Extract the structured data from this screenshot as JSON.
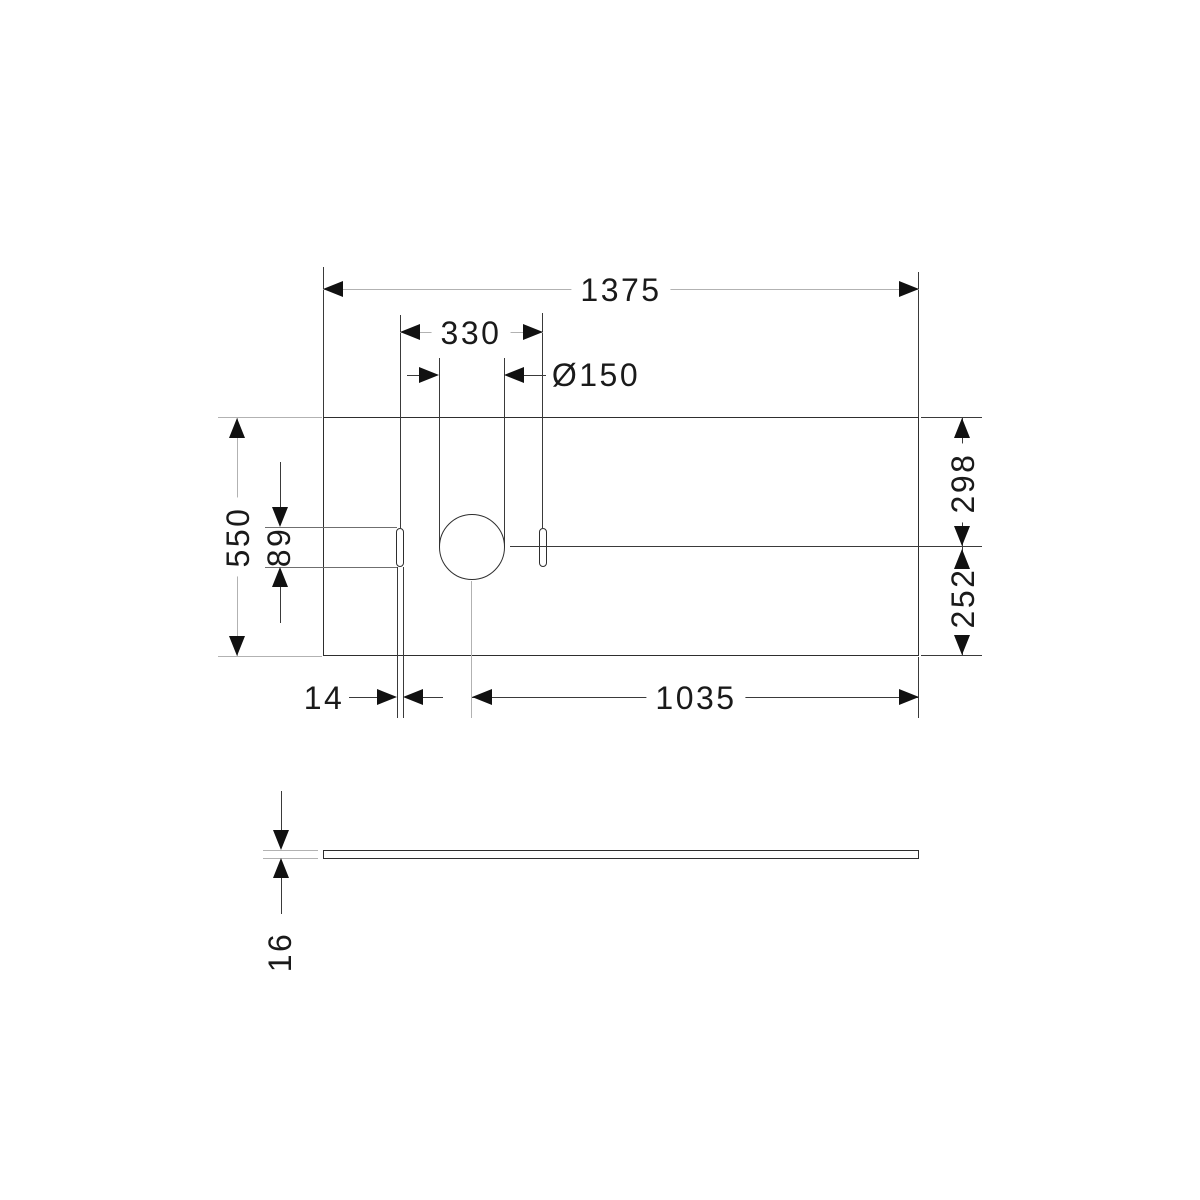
{
  "drawing": {
    "type": "technical-dimension-drawing",
    "views": {
      "top_view": "plate with one round hole and two slotted holes",
      "side_view": "thin plate profile"
    },
    "dimensions": {
      "overall_width": "1375",
      "slot_to_slot": "330",
      "hole_diameter": "Ø150",
      "overall_depth": "550",
      "slot_length": "89",
      "center_to_back_edge": "298",
      "center_to_front_edge": "252",
      "slot_width": "14",
      "hole_center_to_right_edge": "1035",
      "plate_thickness": "16"
    },
    "colors": {
      "background": "#ffffff",
      "outline": "#2e2e2e",
      "extension_line_gray": "#b2b2b2",
      "dimension_line_dark": "#3a3a3a",
      "arrow": "#111111",
      "text": "#1a1a1a"
    }
  }
}
